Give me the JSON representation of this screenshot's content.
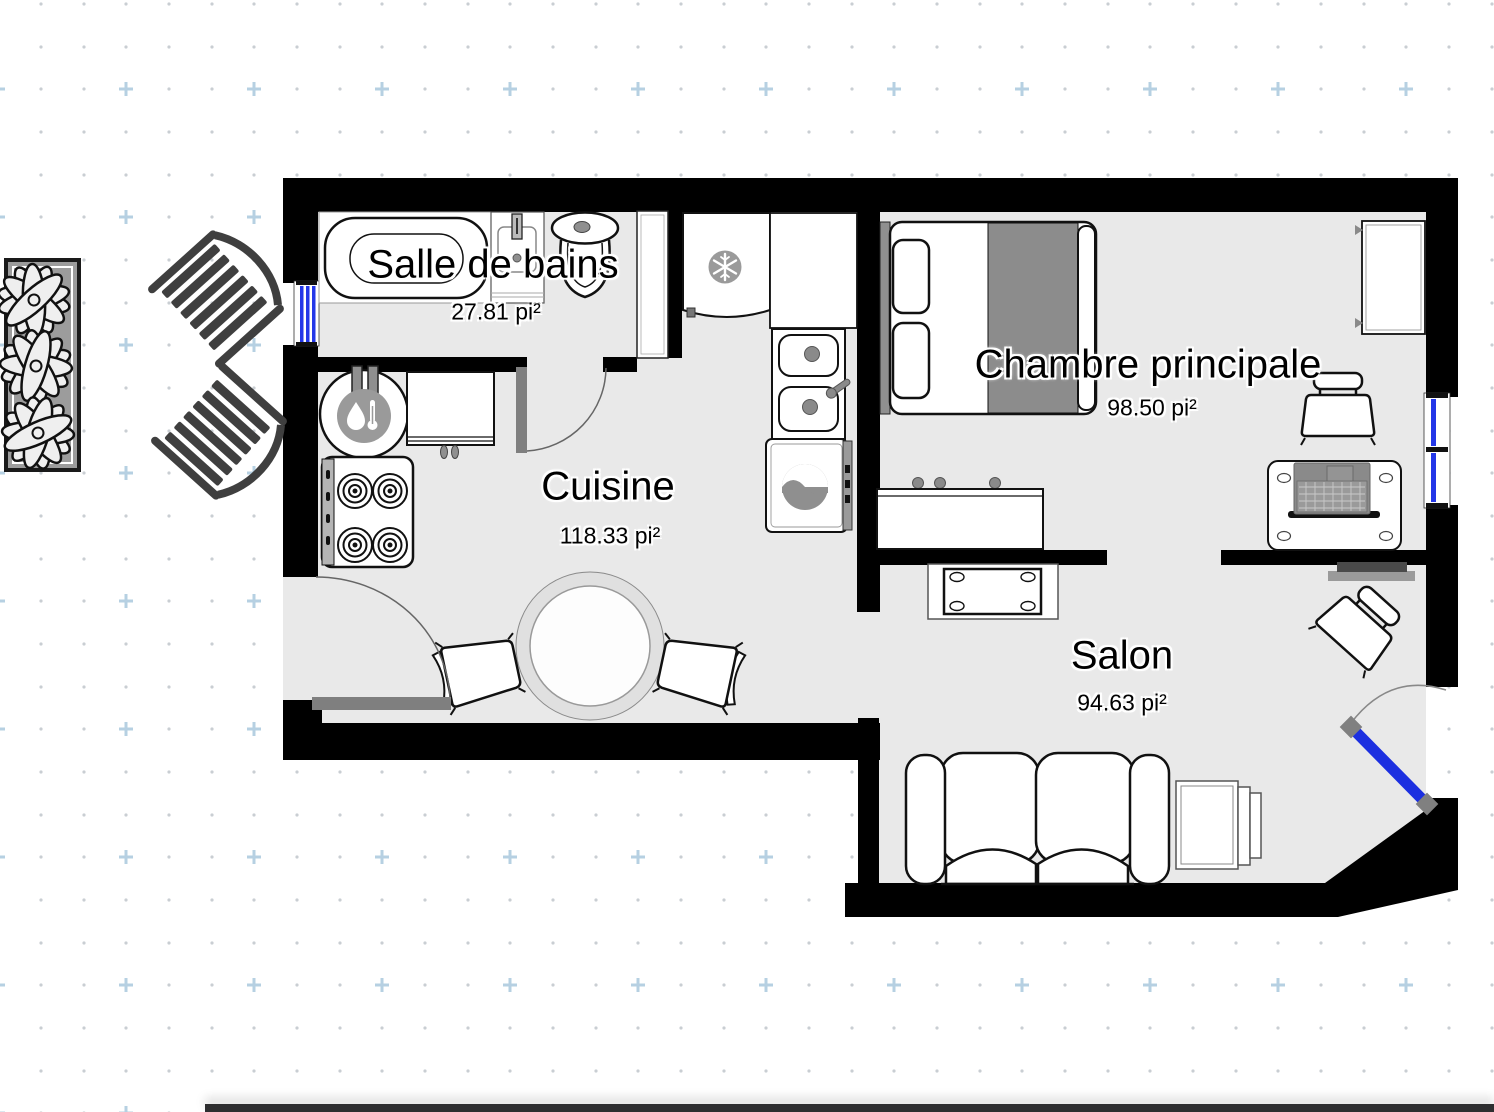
{
  "app": {
    "background": "#ffffff",
    "grid": {
      "dot_color": "#c9ced3",
      "cross_color": "#b6d0e2"
    }
  },
  "plan": {
    "wall_color": "#000000",
    "floor_color": "#e9e9e9",
    "window_color": "#2337e8",
    "door_leaf_color": "#7f7f7f",
    "balcony_door_color": "#1c2fe0",
    "area_unit": "pi²"
  },
  "rooms": [
    {
      "id": "salle-de-bains",
      "name": "Salle de bains",
      "area": "27.81 pi²"
    },
    {
      "id": "cuisine",
      "name": "Cuisine",
      "area": "118.33 pi²"
    },
    {
      "id": "chambre-principale",
      "name": "Chambre principale",
      "area": "98.50 pi²"
    },
    {
      "id": "salon",
      "name": "Salon",
      "area": "94.63 pi²"
    }
  ],
  "furniture": [
    "bathtub",
    "bathroom-sink",
    "toilet",
    "tall-cabinet",
    "water-heater",
    "cabinet",
    "stove",
    "fridge",
    "kitchen-counter",
    "double-sink",
    "washer",
    "dining-table",
    "kitchen-chair",
    "bed",
    "dresser",
    "wardrobe",
    "desk",
    "laptop",
    "desk-chair",
    "tv",
    "coffee-table",
    "sofa",
    "tv-stand",
    "salon-chair",
    "outdoor-deck-chair",
    "planter-with-flowers"
  ]
}
